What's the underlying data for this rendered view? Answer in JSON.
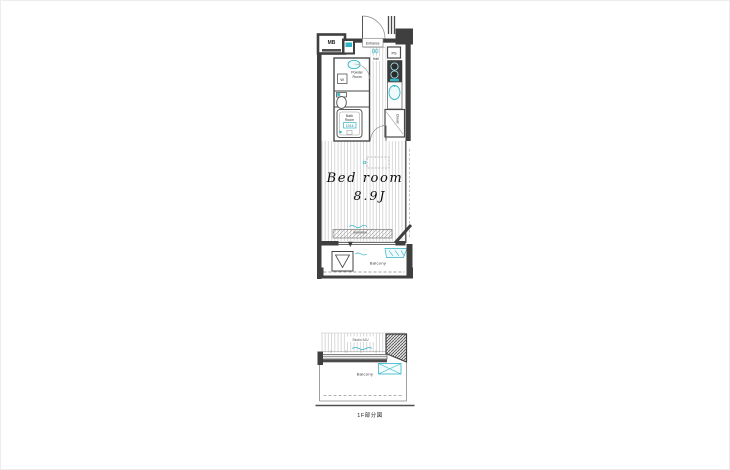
{
  "colors": {
    "wall": "#3f3f3f",
    "line": "#666666",
    "accent_teal": "#2fb5c6",
    "hatch": "#cccccc",
    "background": "#ffffff"
  },
  "main_plan": {
    "labels": {
      "mb": "MB",
      "entrance": "Entrance",
      "hall": "Hall",
      "ps": "PS",
      "powder_line1": "Powder",
      "powder_line2": "Room",
      "washer": "W",
      "bath_line1": "Bath",
      "bath_line2": "Room",
      "bath_size": "1014",
      "closet": "Closet",
      "bedroom_name": "Bed room",
      "bedroom_size": "8.9J",
      "balcony": "Balcony"
    }
  },
  "sub_plan": {
    "labels": {
      "room": "Studio 6JU",
      "balcony": "Balcony",
      "caption": "1F部分図"
    }
  }
}
